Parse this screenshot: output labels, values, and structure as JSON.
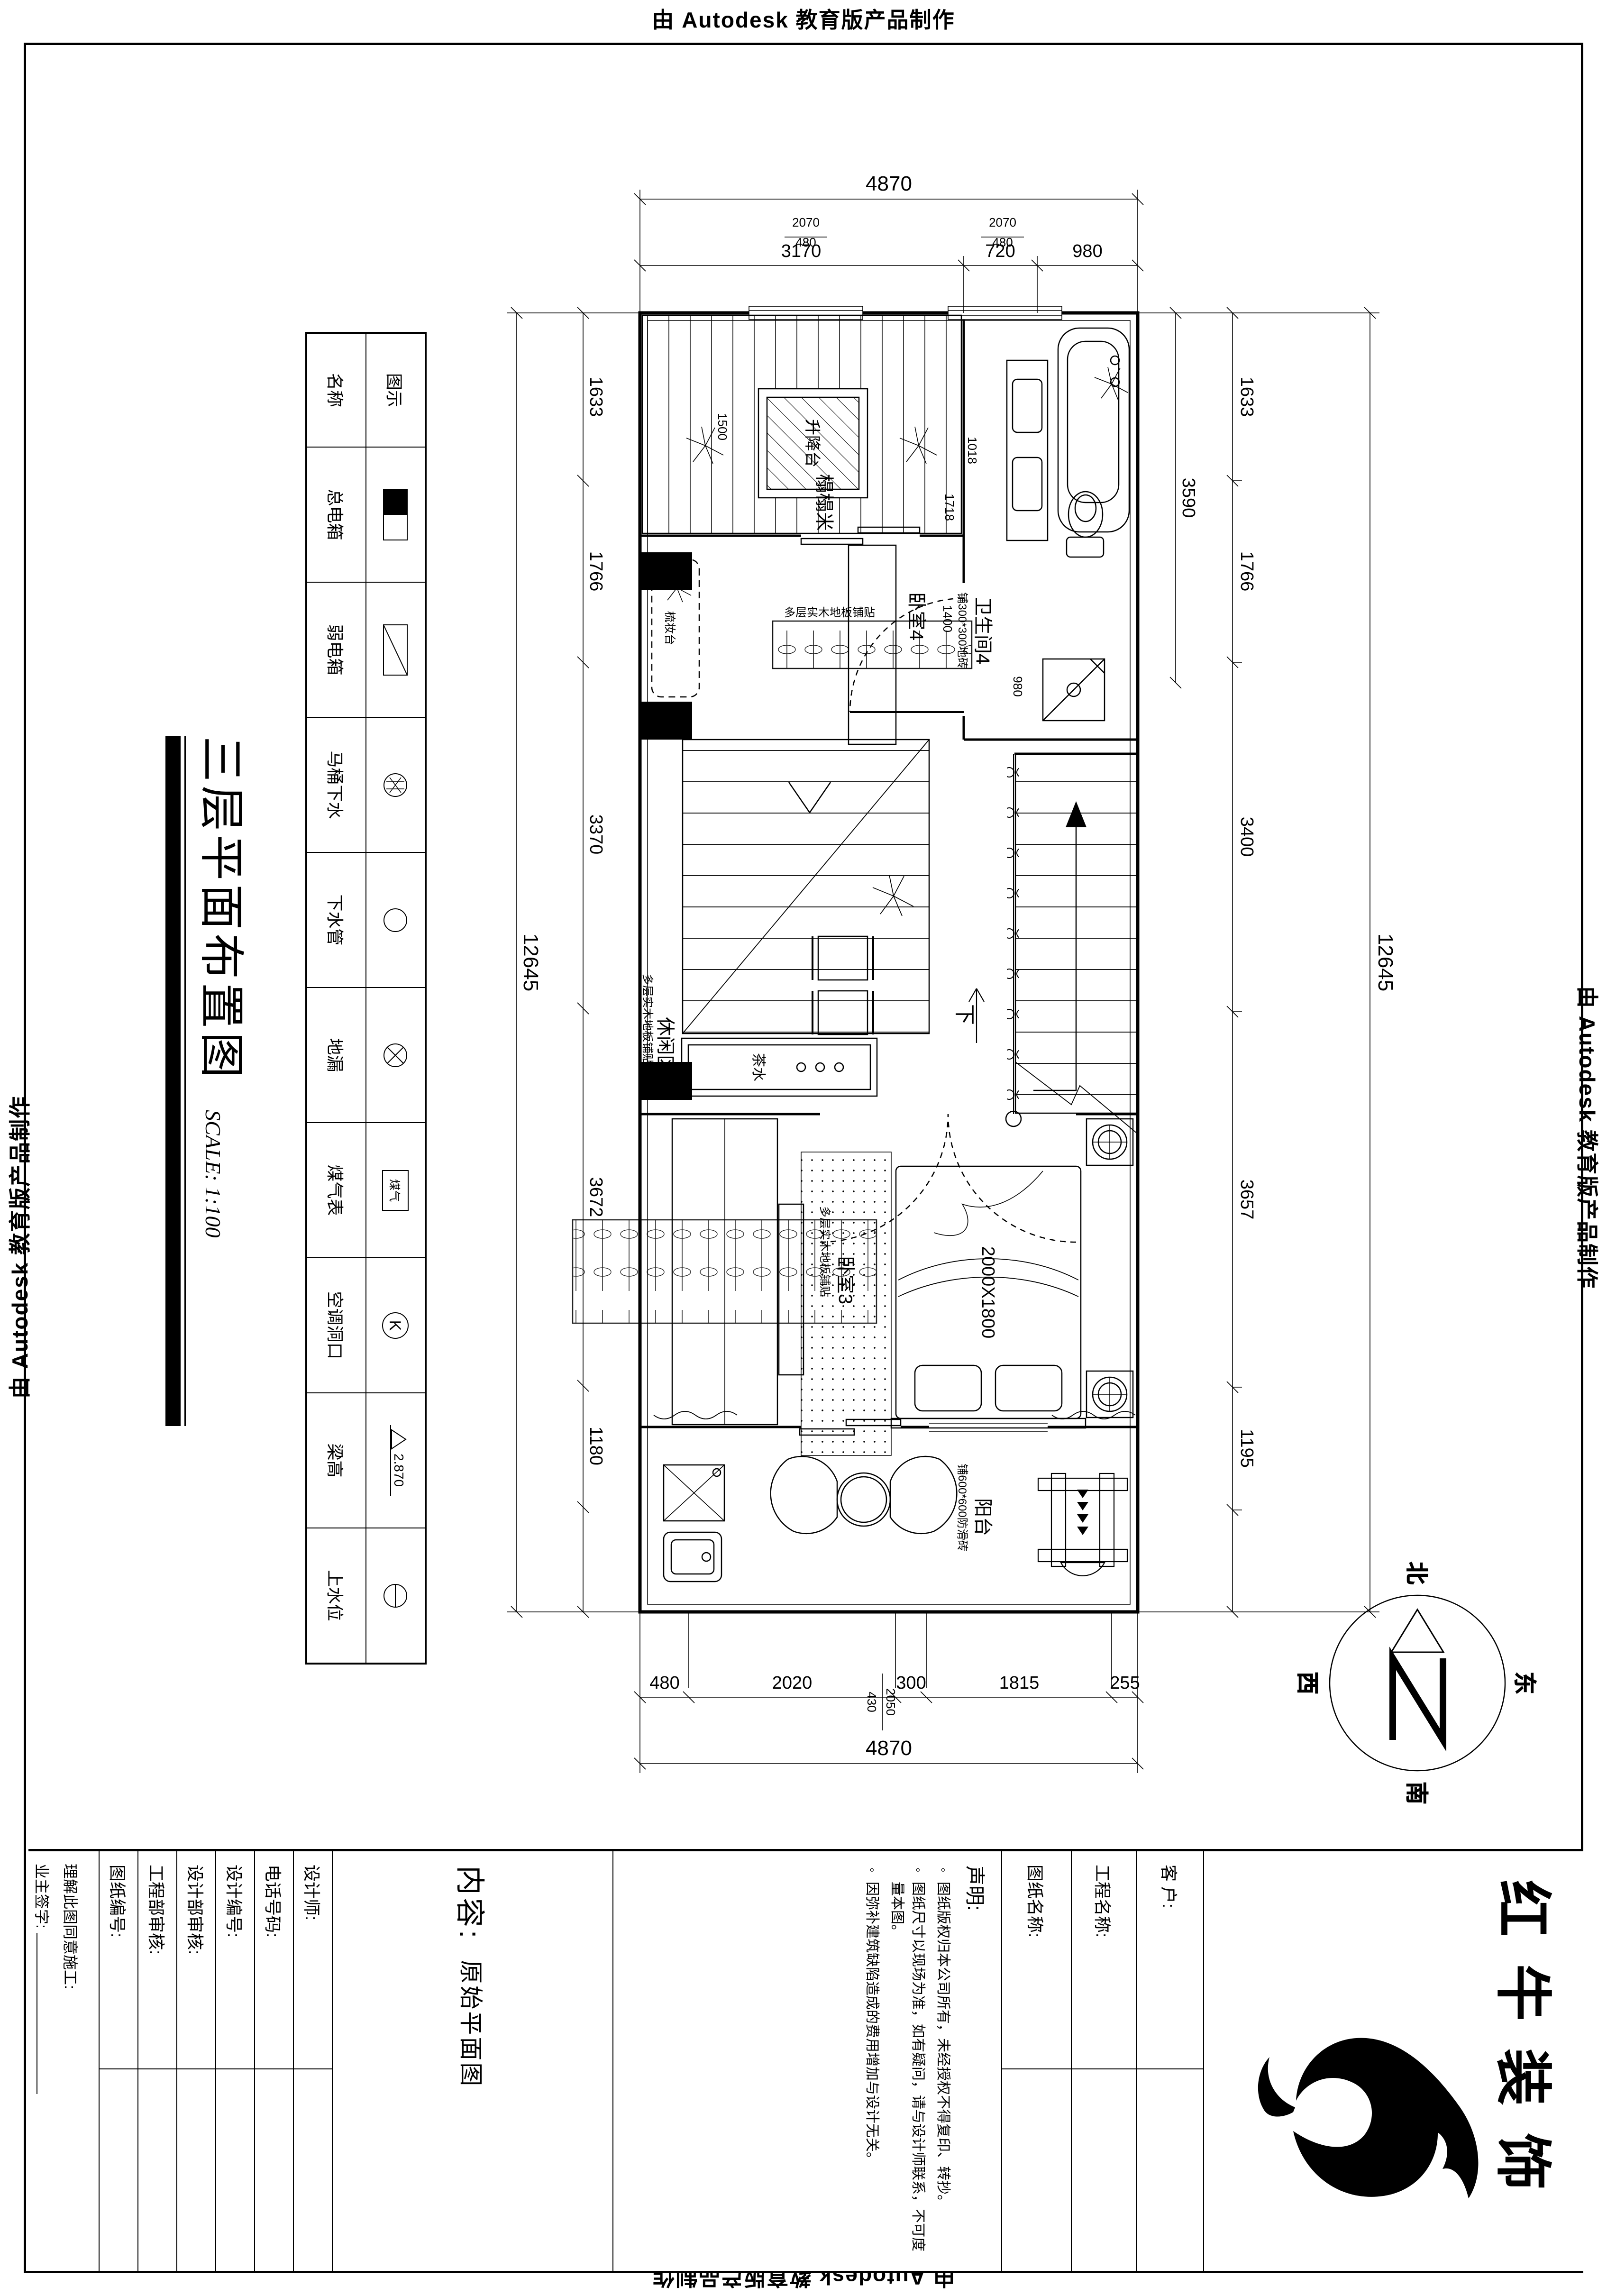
{
  "watermark": "由 Autodesk 教育版产品制作",
  "plan_title": {
    "name": "三层平面布置图",
    "scale": "SCALE: 1:100"
  },
  "legend": {
    "header_symbol": "图示",
    "header_name": "名称",
    "items": [
      "总电箱",
      "弱电箱",
      "马桶下水",
      "下水管",
      "地漏",
      "煤气表",
      "空调洞口",
      "梁高",
      "上水位"
    ],
    "gas_text": "煤气",
    "ac_text": "K",
    "beam_value": "2.870"
  },
  "labels": {
    "bathroom": "卫生间4",
    "bathroom_note": "铺300*300地砖",
    "bedroom4": "卧室4",
    "bedroom3": "卧室3",
    "wood_floor_note": "多层实木地板铺贴",
    "tatami": "榻榻米",
    "lift_table": "升降台",
    "dresser": "梳妆台",
    "tea": "茶水",
    "leisure": "休闲区",
    "down": "下",
    "balcony": "阳台",
    "balcony_note": "铺600*600防滑砖",
    "bed_size": "2000X1800"
  },
  "dims": {
    "top_total": "12645",
    "top": [
      "1633",
      "1766",
      "3400",
      "3657",
      "1195"
    ],
    "bottom_total": "12645",
    "bottom": [
      "1633",
      "1766",
      "3370",
      "3672",
      "1180"
    ],
    "left_total": "4870",
    "left": [
      "980",
      "720",
      "3170"
    ],
    "right_total": "4870",
    "right": [
      "255",
      "1815",
      "300",
      "2020",
      "480"
    ],
    "window_w": "2070",
    "window_h": "480",
    "door_w": "2050",
    "door_h": "430",
    "bath_width": "3590",
    "tub_w": "1018",
    "tub_l": "1718",
    "wc_w": "1400",
    "shower_w": "980",
    "lift_w": "1500"
  },
  "compass": {
    "north": "北",
    "east": "东",
    "south": "南",
    "west": "西"
  },
  "title_block": {
    "logo_text": "红牛装饰",
    "client_label": "客 户:",
    "project_label": "工程名称:",
    "drawing_label": "图纸名称:",
    "declaration_title": "声明:",
    "declaration_items": [
      "图纸版权归本公司所有，未经授权不得复印、转抄。",
      "图纸尺寸以现场为准，如有疑问，请与设计师联系，不可度量本图。",
      "因弥补建筑缺陷造成的费用增加与设计无关。"
    ],
    "content_label": "内容:",
    "content_value": "原始平面图",
    "designer_label": "设计师:",
    "phone_label": "电话号码:",
    "design_no_label": "设计编号:",
    "design_review_label": "设计部审核:",
    "eng_review_label": "工程部审核:",
    "drawing_no_label": "图纸编号:",
    "agree_label": "理解此图同意施工:",
    "owner_sign_label": "业主签字:"
  }
}
